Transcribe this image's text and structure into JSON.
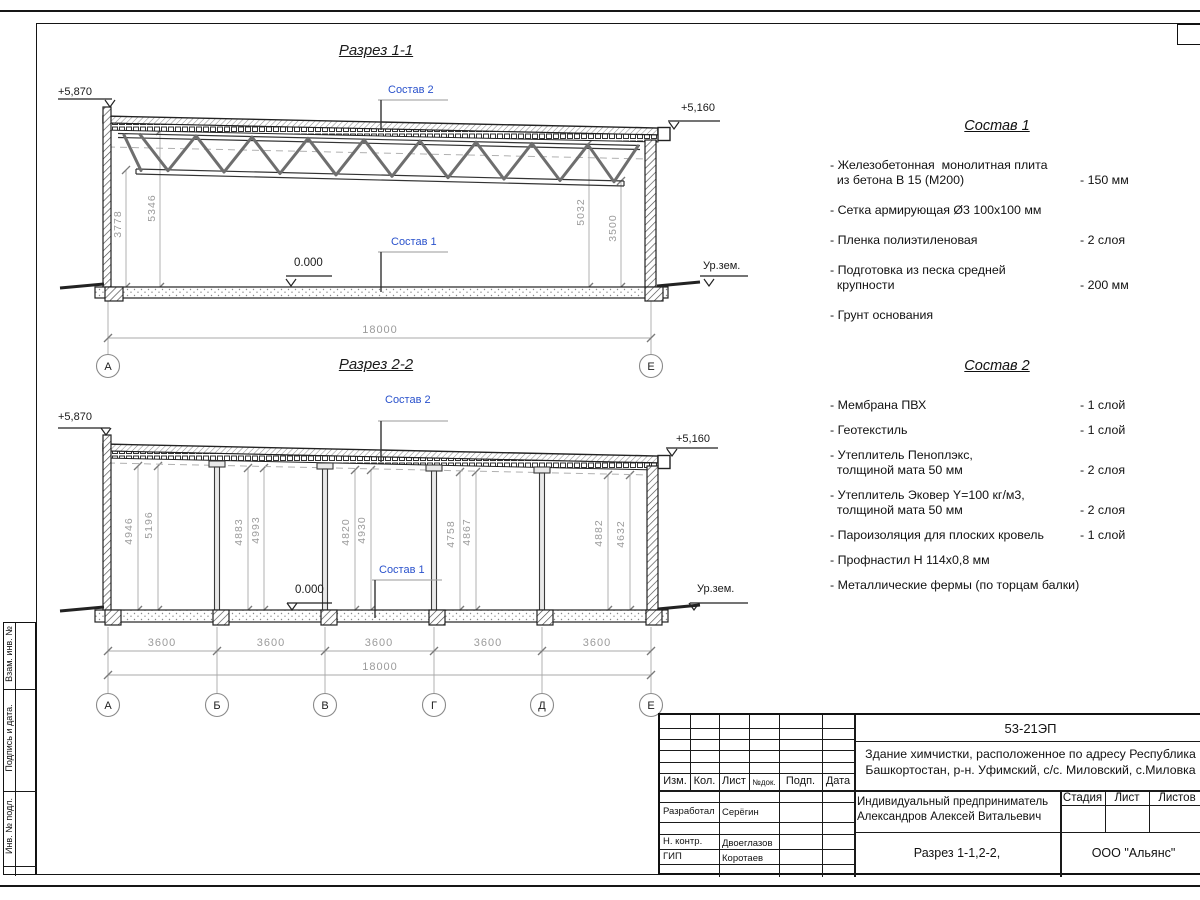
{
  "section1": {
    "title": "Разрез 1-1",
    "elev_left": "+5,870",
    "elev_right": "+5,160",
    "elev_zero": "0.000",
    "ground": "Ур.зем.",
    "sostav1_label": "Состав 1",
    "sostav2_label": "Состав 2",
    "dim_3778": "3778",
    "dim_5346": "5346",
    "dim_5032": "5032",
    "dim_3500": "3500",
    "dim_total": "18000",
    "grid_a": "А",
    "grid_e": "Е"
  },
  "section2": {
    "title": "Разрез 2-2",
    "elev_left": "+5,870",
    "elev_right": "+5,160",
    "elev_zero": "0.000",
    "ground": "Ур.зем.",
    "sostav1_label": "Состав 1",
    "sostav2_label": "Состав 2",
    "vdims": [
      "4946",
      "5196",
      "4883",
      "4993",
      "4820",
      "4930",
      "4758",
      "4867",
      "4882",
      "4632"
    ],
    "spacings": [
      "3600",
      "3600",
      "3600",
      "3600",
      "3600"
    ],
    "dim_total": "18000",
    "grids": [
      "А",
      "Б",
      "В",
      "Г",
      "Д",
      "Е"
    ]
  },
  "sostav1": {
    "title": "Состав 1",
    "items": [
      {
        "name": "- Железобетонная  монолитная плита\n  из бетона В 15 (М200)",
        "value": "- 150 мм"
      },
      {
        "name": "- Сетка армирующая Ø3 100х100 мм",
        "value": ""
      },
      {
        "name": "- Пленка полиэтиленовая",
        "value": "-  2 слоя"
      },
      {
        "name": "- Подготовка из песка средней\n  крупности",
        "value": "- 200 мм"
      },
      {
        "name": "- Грунт основания",
        "value": ""
      }
    ]
  },
  "sostav2": {
    "title": "Состав 2",
    "items": [
      {
        "name": "- Мембрана ПВХ",
        "value": "- 1 слой"
      },
      {
        "name": "- Геотекстиль",
        "value": "- 1 слой"
      },
      {
        "name": "- Утеплитель Пеноплэкс,\n  толщиной мата 50 мм",
        "value": "- 2 слоя"
      },
      {
        "name": "- Утеплитель Эковер Y=100 кг/м3,\n  толщиной мата 50 мм",
        "value": "- 2 слоя"
      },
      {
        "name": "- Пароизоляция для плоских кровель",
        "value": "- 1 слой"
      },
      {
        "name": "- Профнастил Н 114х0,8 мм",
        "value": ""
      },
      {
        "name": "- Металлические фермы (по торцам балки)",
        "value": ""
      }
    ]
  },
  "titleblock": {
    "doc_code": "53-21ЭП",
    "description_line1": "Здание химчистки,  расположенное по адресу Республика",
    "description_line2": "Башкортостан, р-н. Уфимский, с/с. Миловский, с.Миловка",
    "col_izm": "Изм.",
    "col_kol": "Кол.",
    "col_list": "Лист",
    "col_ndok": "№док.",
    "col_podp": "Подп.",
    "col_data": "Дата",
    "roles": [
      {
        "role": "Разработал",
        "name": "Серёгин"
      },
      {
        "role": "Н. контр.",
        "name": "Двоеглазов"
      },
      {
        "role": "ГИП",
        "name": "Коротаев"
      }
    ],
    "client_line1": "Индивидуальный предприниматель",
    "client_line2": "Александров Алексей Витальевич",
    "stage_label": "Стадия",
    "sheet_label": "Лист",
    "sheets_label": "Листов",
    "drawing_title": "Разрез 1-1,2-2,",
    "org": "ООО \"Альянс\""
  },
  "sidebar": {
    "vzam": "Взам. инв. №",
    "podpis": "Подпись и дата.",
    "inv": "Инв. № подл."
  },
  "colors": {
    "accent_blue": "#2a52cc",
    "dim_gray": "#9b9b9b",
    "line": "#1a1a1a"
  }
}
